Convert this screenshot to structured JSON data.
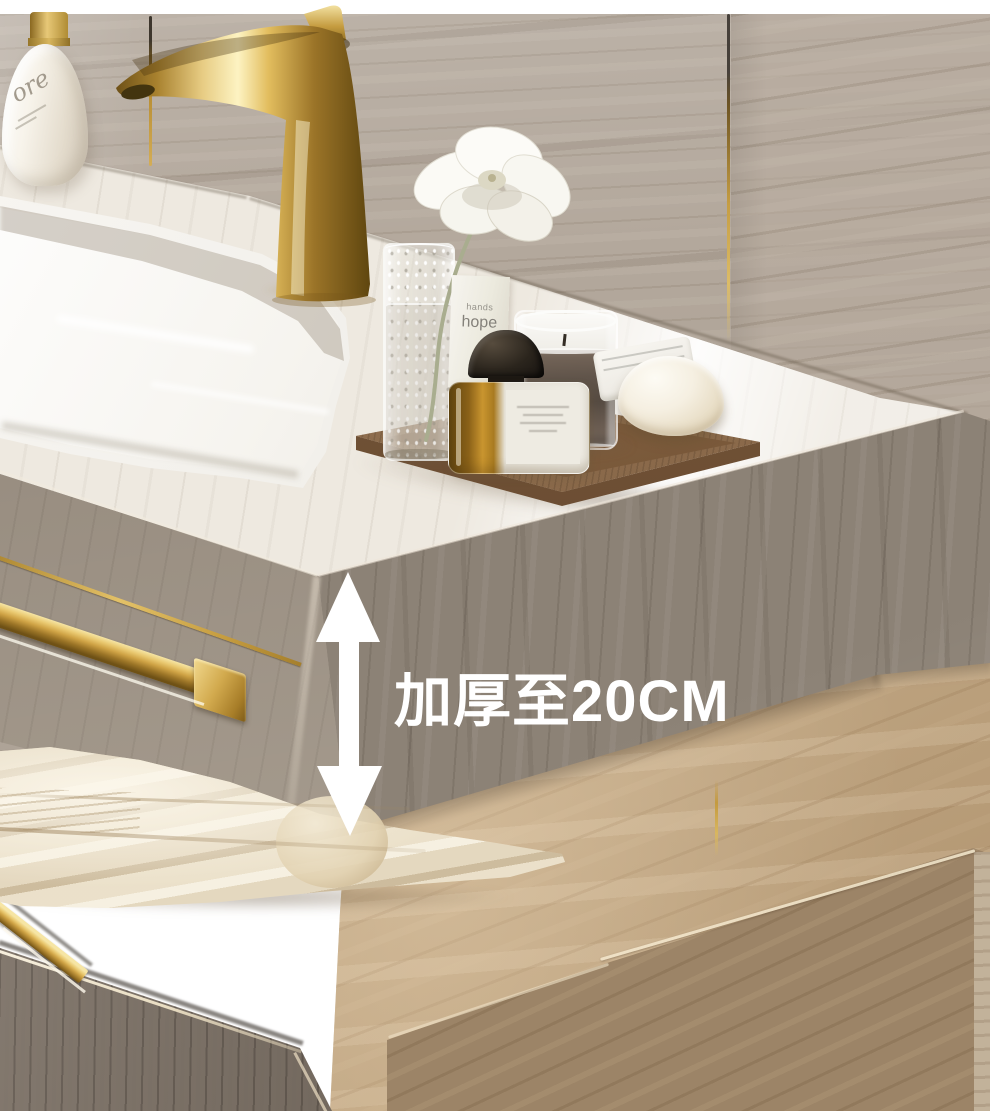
{
  "scene": {
    "type": "product-photo",
    "subject": "Wall-mounted marble bathroom vanity with integrated sink, gold fixtures, decor tray, folded towel and lower stone bench with wood drawer"
  },
  "annotation": {
    "text": "加厚至20CM",
    "text_color": "#ffffff",
    "arrow": {
      "style": "double-headed",
      "orientation": "vertical",
      "color": "#ffffff"
    }
  },
  "products": {
    "lotion_bottle": {
      "script_text": "ore"
    },
    "hand_cream_box": {
      "line1": "hands",
      "line2": "hope"
    }
  },
  "objects": {
    "faucet": "gold curved-spout basin faucet",
    "sink": "integrated white marble basin",
    "flower": "white flower in speckled glass vase",
    "perfume_bottle": "black dome-cap amber perfume bottle with white label",
    "candle": "grey wax candle in glass tumbler",
    "soap": "cream soap bar on folded white cloth",
    "tray": "brown wooden vanity tray",
    "towel_bar": "gold towel bar on slab front",
    "towel": "folded cream towel",
    "cabinet": "wood-grain drawer with gold edge handle"
  },
  "colors": {
    "gold_accent": "#c9a24b",
    "upper_wall": "#b3a89c",
    "counter_marble": "#eee9e0",
    "slab_face": "#8c8276",
    "lower_wall": "#c0a580",
    "bench_face": "#9c8467",
    "towel": "#e6dac1",
    "wood": "#7f7367",
    "annotation_white": "#ffffff"
  }
}
